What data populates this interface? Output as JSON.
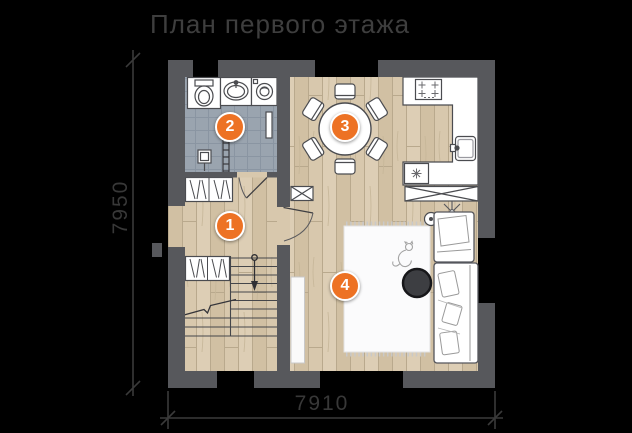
{
  "title": "План первого этажа",
  "dimensions": {
    "left": "7950",
    "bottom": "7910"
  },
  "markers": [
    {
      "number": "1",
      "room": "hallway-stairs"
    },
    {
      "number": "2",
      "room": "bathroom"
    },
    {
      "number": "3",
      "room": "kitchen-dining"
    },
    {
      "number": "4",
      "room": "living-room"
    }
  ],
  "colors": {
    "accent": "#ed7224",
    "wall": "#57585c",
    "wood_floor": "#d8c8ad",
    "tile_floor": "#9aa4af",
    "background": "#000000",
    "text": "#3e3e3e"
  }
}
